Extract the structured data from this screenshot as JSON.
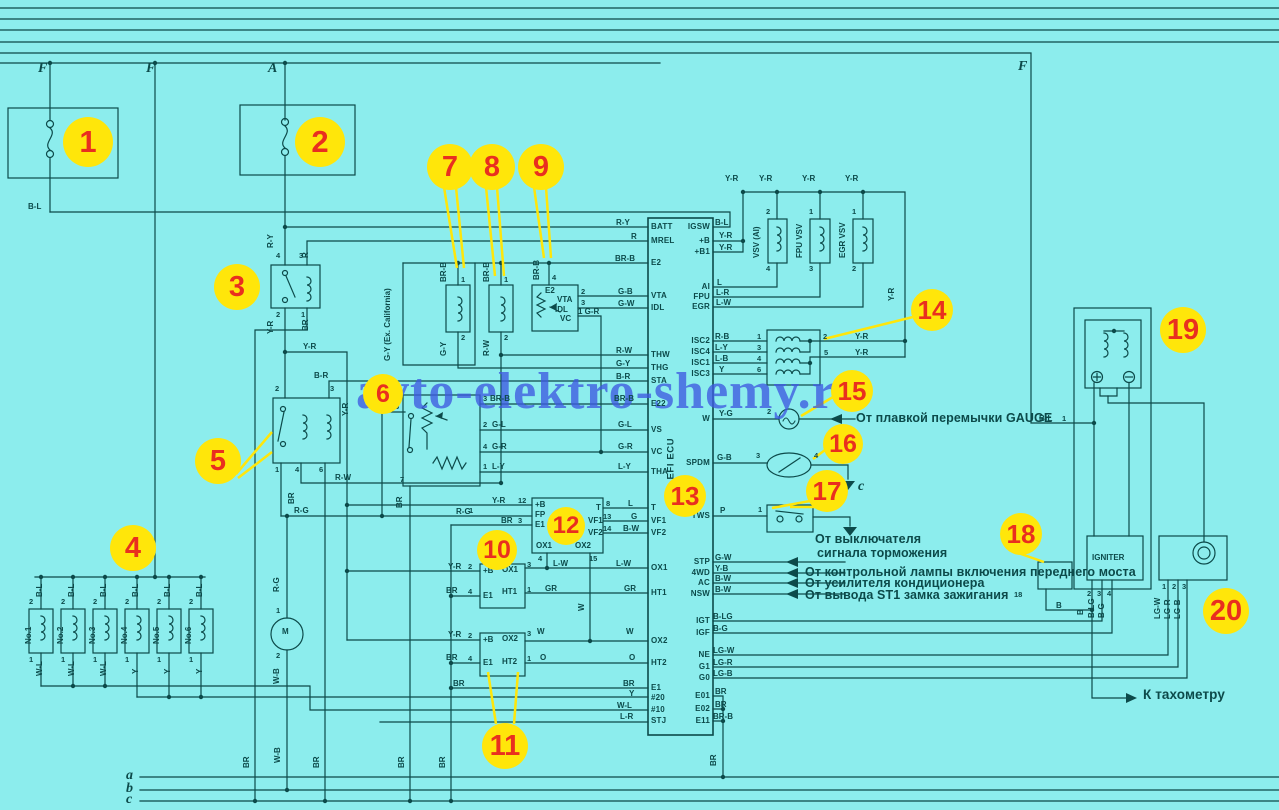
{
  "watermark": "avto-elektro-shemy.ru",
  "palette": {
    "background": "#8ceded",
    "ink": "#0c4a4a",
    "badge_fill": "#ffe60a",
    "badge_number": "#e92f1f",
    "watermark_color": "#3d5ae0"
  },
  "ecu": {
    "label": "EFI ECU",
    "left_pins": [
      [
        "BATT",
        227
      ],
      [
        "MREL",
        241
      ],
      [
        "E2",
        263
      ],
      [
        "VTA",
        296
      ],
      [
        "IDL",
        308
      ],
      [
        "THW",
        355
      ],
      [
        "THG",
        368
      ],
      [
        "STA",
        381
      ],
      [
        "E22",
        404
      ],
      [
        "VS",
        430
      ],
      [
        "VC",
        452
      ],
      [
        "THA",
        472
      ],
      [
        "T",
        508
      ],
      [
        "VF1",
        521
      ],
      [
        "VF2",
        533
      ],
      [
        "OX1",
        568
      ],
      [
        "HT1",
        593
      ],
      [
        "OX2",
        641
      ],
      [
        "HT2",
        663
      ],
      [
        "E1",
        688
      ],
      [
        "#20",
        698
      ],
      [
        "#10",
        710
      ],
      [
        "STJ",
        721
      ]
    ],
    "right_pins": [
      [
        "IGSW",
        227
      ],
      [
        "+B",
        241
      ],
      [
        "+B1",
        252
      ],
      [
        "AI",
        287
      ],
      [
        "FPU",
        297
      ],
      [
        "EGR",
        307
      ],
      [
        "ISC2",
        341
      ],
      [
        "ISC4",
        352
      ],
      [
        "ISC1",
        363
      ],
      [
        "ISC3",
        374
      ],
      [
        "W",
        419
      ],
      [
        "SPDM",
        463
      ],
      [
        "TWS",
        516
      ],
      [
        "STP",
        562
      ],
      [
        "4WD",
        573
      ],
      [
        "AC",
        583
      ],
      [
        "NSW",
        594
      ],
      [
        "IGT",
        621
      ],
      [
        "IGF",
        633
      ],
      [
        "NE",
        655
      ],
      [
        "G1",
        667
      ],
      [
        "G0",
        678
      ],
      [
        "E01",
        696
      ],
      [
        "E02",
        709
      ],
      [
        "E11",
        721
      ]
    ]
  },
  "serif_labels": [
    [
      "F",
      38,
      62
    ],
    [
      "F",
      146,
      62
    ],
    [
      "A",
      268,
      62
    ],
    [
      "F",
      1018,
      60
    ],
    [
      "a",
      126,
      769
    ],
    [
      "b",
      126,
      782
    ],
    [
      "c",
      126,
      793
    ],
    [
      "c",
      858,
      480
    ]
  ],
  "annotations": [
    [
      "От плавкой перемычки GAUGE",
      856,
      412,
      ""
    ],
    [
      "От выключателя",
      815,
      533,
      ""
    ],
    [
      "сигнала торможения",
      817,
      547,
      ""
    ],
    [
      "От контрольной лампы включения переднего моста",
      805,
      566,
      ""
    ],
    [
      "От усилителя кондиционера",
      805,
      577,
      ""
    ],
    [
      "От вывода ST1 замка зажигания",
      805,
      589,
      ""
    ],
    [
      "К тахометру",
      1143,
      688,
      "big"
    ]
  ],
  "component_labels": [
    [
      "VSV (AI)",
      761,
      259,
      1
    ],
    [
      "FPU VSV",
      804,
      259,
      1
    ],
    [
      "EGR VSV",
      847,
      259,
      1
    ],
    [
      "IGNITER",
      1092,
      554,
      0
    ],
    [
      "M",
      282,
      628,
      0
    ],
    [
      "No.1",
      33,
      645,
      1
    ],
    [
      "No.2",
      65,
      645,
      1
    ],
    [
      "No.3",
      97,
      645,
      1
    ],
    [
      "No.4",
      129,
      645,
      1
    ],
    [
      "No.5",
      161,
      645,
      1
    ],
    [
      "No.6",
      193,
      645,
      1
    ],
    [
      "G-Y (Ex. California)",
      392,
      362,
      1
    ],
    [
      "E2",
      545,
      287,
      0
    ],
    [
      "VTA",
      557,
      296,
      0
    ],
    [
      "IDL",
      555,
      306,
      0
    ],
    [
      "VC",
      560,
      315,
      0
    ],
    [
      "+B",
      535,
      501,
      0
    ],
    [
      "FP",
      535,
      511,
      0
    ],
    [
      "E1",
      535,
      521,
      0
    ],
    [
      "T",
      596,
      504,
      0
    ],
    [
      "VF1",
      588,
      517,
      0
    ],
    [
      "VF2",
      588,
      529,
      0
    ],
    [
      "OX1",
      536,
      542,
      0
    ],
    [
      "OX2",
      575,
      542,
      0
    ],
    [
      "+B",
      483,
      567,
      0
    ],
    [
      "OX1",
      502,
      566,
      0
    ],
    [
      "E1",
      483,
      592,
      0
    ],
    [
      "HT1",
      502,
      588,
      0
    ],
    [
      "+B",
      483,
      636,
      0
    ],
    [
      "OX2",
      502,
      635,
      0
    ],
    [
      "E1",
      483,
      659,
      0
    ],
    [
      "HT2",
      502,
      658,
      0
    ]
  ],
  "wire_labels": [
    [
      "B-L",
      28,
      203,
      0
    ],
    [
      "R-Y",
      616,
      219,
      0
    ],
    [
      "R",
      631,
      233,
      0
    ],
    [
      "BR-B",
      615,
      255,
      0
    ],
    [
      "G-B",
      618,
      288,
      0
    ],
    [
      "G-W",
      618,
      300,
      0
    ],
    [
      "1 G-R",
      578,
      308,
      0
    ],
    [
      "R-W",
      616,
      347,
      0
    ],
    [
      "G-Y",
      616,
      360,
      0
    ],
    [
      "B-R",
      616,
      373,
      0
    ],
    [
      "B-R",
      314,
      372,
      0
    ],
    [
      "Y-R",
      303,
      343,
      0
    ],
    [
      "BR-B",
      614,
      395,
      0
    ],
    [
      "G-L",
      618,
      421,
      0
    ],
    [
      "G-R",
      618,
      443,
      0
    ],
    [
      "L-Y",
      618,
      463,
      0
    ],
    [
      "BR-B",
      490,
      395,
      0
    ],
    [
      "G-L",
      492,
      421,
      0
    ],
    [
      "G-R",
      492,
      443,
      0
    ],
    [
      "L-Y",
      492,
      463,
      0
    ],
    [
      "L",
      628,
      500,
      0
    ],
    [
      "G",
      631,
      513,
      0
    ],
    [
      "B-W",
      623,
      525,
      0
    ],
    [
      "Y-R",
      492,
      497,
      0
    ],
    [
      "R-G",
      456,
      508,
      0
    ],
    [
      "BR",
      501,
      517,
      0
    ],
    [
      "L-W",
      553,
      560,
      0
    ],
    [
      "L-W",
      616,
      560,
      0
    ],
    [
      "GR",
      545,
      585,
      0
    ],
    [
      "GR",
      624,
      585,
      0
    ],
    [
      "W",
      537,
      628,
      0
    ],
    [
      "W",
      626,
      628,
      0
    ],
    [
      "O",
      540,
      654,
      0
    ],
    [
      "O",
      629,
      654,
      0
    ],
    [
      "BR",
      453,
      680,
      0
    ],
    [
      "BR",
      623,
      680,
      0
    ],
    [
      "Y",
      629,
      690,
      0
    ],
    [
      "W-L",
      617,
      702,
      0
    ],
    [
      "L-R",
      620,
      713,
      0
    ],
    [
      "Y-R",
      448,
      563,
      0
    ],
    [
      "BR",
      446,
      587,
      0
    ],
    [
      "Y-R",
      448,
      631,
      0
    ],
    [
      "BR",
      446,
      654,
      0
    ],
    [
      "R-W",
      335,
      474,
      0
    ],
    [
      "R-G",
      294,
      507,
      0
    ],
    [
      "B-L",
      715,
      219,
      0
    ],
    [
      "Y-R",
      719,
      232,
      0
    ],
    [
      "Y-R",
      719,
      244,
      0
    ],
    [
      "L",
      717,
      279,
      0
    ],
    [
      "L-R",
      716,
      289,
      0
    ],
    [
      "L-W",
      716,
      299,
      0
    ],
    [
      "R-B",
      715,
      333,
      0
    ],
    [
      "L-Y",
      715,
      344,
      0
    ],
    [
      "L-B",
      715,
      355,
      0
    ],
    [
      "Y",
      719,
      366,
      0
    ],
    [
      "Y-G",
      719,
      410,
      0
    ],
    [
      "G-B",
      717,
      454,
      0
    ],
    [
      "P",
      720,
      507,
      0
    ],
    [
      "G-W",
      715,
      554,
      0
    ],
    [
      "Y-B",
      715,
      565,
      0
    ],
    [
      "B-W",
      715,
      575,
      0
    ],
    [
      "B-W",
      715,
      586,
      0
    ],
    [
      "B-LG",
      713,
      613,
      0
    ],
    [
      "B-G",
      713,
      625,
      0
    ],
    [
      "LG-W",
      713,
      647,
      0
    ],
    [
      "LG-R",
      713,
      659,
      0
    ],
    [
      "LG-B",
      713,
      670,
      0
    ],
    [
      "BR",
      715,
      688,
      0
    ],
    [
      "BR",
      715,
      701,
      0
    ],
    [
      "BR-B",
      713,
      713,
      0
    ],
    [
      "Y-R",
      725,
      175,
      0
    ],
    [
      "Y-R",
      759,
      175,
      0
    ],
    [
      "Y-R",
      802,
      175,
      0
    ],
    [
      "Y-R",
      845,
      175,
      0
    ],
    [
      "Y-R",
      855,
      333,
      0
    ],
    [
      "Y-R",
      855,
      349,
      0
    ],
    [
      "B-L",
      1039,
      415,
      0
    ],
    [
      "B",
      1056,
      602,
      0
    ],
    [
      "R-Y",
      275,
      249,
      1
    ],
    [
      "R",
      310,
      259,
      1
    ],
    [
      "Y-R",
      275,
      335,
      1
    ],
    [
      "BR",
      310,
      332,
      1
    ],
    [
      "Y-R",
      350,
      417,
      1
    ],
    [
      "BR-B",
      448,
      283,
      1
    ],
    [
      "BR-B",
      491,
      283,
      1
    ],
    [
      "BR-B",
      541,
      281,
      1
    ],
    [
      "G-Y",
      448,
      357,
      1
    ],
    [
      "R-W",
      491,
      357,
      1
    ],
    [
      "R-G",
      281,
      593,
      1
    ],
    [
      "W-B",
      281,
      685,
      1
    ],
    [
      "BR",
      296,
      505,
      1
    ],
    [
      "BR",
      404,
      509,
      1
    ],
    [
      "BR",
      251,
      769,
      1
    ],
    [
      "W-B",
      282,
      764,
      1
    ],
    [
      "BR",
      321,
      769,
      1
    ],
    [
      "BR",
      406,
      769,
      1
    ],
    [
      "BR",
      447,
      769,
      1
    ],
    [
      "BR",
      718,
      767,
      1
    ],
    [
      "B-L",
      44,
      598,
      1
    ],
    [
      "B-L",
      76,
      598,
      1
    ],
    [
      "B-L",
      108,
      598,
      1
    ],
    [
      "B-L",
      140,
      598,
      1
    ],
    [
      "B-L",
      172,
      598,
      1
    ],
    [
      "B-L",
      204,
      598,
      1
    ],
    [
      "W-L",
      44,
      677,
      1
    ],
    [
      "W-L",
      76,
      677,
      1
    ],
    [
      "W-L",
      108,
      677,
      1
    ],
    [
      "Y",
      140,
      675,
      1
    ],
    [
      "Y",
      172,
      675,
      1
    ],
    [
      "Y",
      204,
      675,
      1
    ],
    [
      "W",
      586,
      612,
      1
    ],
    [
      "B",
      1085,
      616,
      1
    ],
    [
      "B-LG",
      1096,
      619,
      1
    ],
    [
      "B-G",
      1106,
      619,
      1
    ],
    [
      "LG-W",
      1162,
      620,
      1
    ],
    [
      "LG-R",
      1172,
      620,
      1
    ],
    [
      "LG-B",
      1182,
      620,
      1
    ],
    [
      "Y-R",
      896,
      302,
      1
    ]
  ],
  "pin_numbers": [
    [
      "4",
      276,
      252
    ],
    [
      "3",
      299,
      252
    ],
    [
      "2",
      276,
      311
    ],
    [
      "1",
      301,
      311
    ],
    [
      "2",
      275,
      385
    ],
    [
      "3",
      330,
      385
    ],
    [
      "1",
      275,
      466
    ],
    [
      "4",
      295,
      466
    ],
    [
      "6",
      319,
      466
    ],
    [
      "1",
      461,
      276
    ],
    [
      "2",
      461,
      334
    ],
    [
      "1",
      504,
      276
    ],
    [
      "2",
      504,
      334
    ],
    [
      "4",
      552,
      274
    ],
    [
      "2",
      581,
      288
    ],
    [
      "3",
      581,
      299
    ],
    [
      "6",
      395,
      403
    ],
    [
      "7",
      400,
      476
    ],
    [
      "3",
      483,
      395
    ],
    [
      "2",
      483,
      421
    ],
    [
      "4",
      483,
      443
    ],
    [
      "1",
      483,
      463
    ],
    [
      "2",
      29,
      598
    ],
    [
      "2",
      61,
      598
    ],
    [
      "2",
      93,
      598
    ],
    [
      "2",
      125,
      598
    ],
    [
      "2",
      157,
      598
    ],
    [
      "2",
      189,
      598
    ],
    [
      "1",
      29,
      656
    ],
    [
      "1",
      61,
      656
    ],
    [
      "1",
      93,
      656
    ],
    [
      "1",
      125,
      656
    ],
    [
      "1",
      157,
      656
    ],
    [
      "1",
      189,
      656
    ],
    [
      "1",
      276,
      607
    ],
    [
      "2",
      276,
      652
    ],
    [
      "12",
      518,
      497
    ],
    [
      "1",
      469,
      507
    ],
    [
      "3",
      518,
      517
    ],
    [
      "8",
      606,
      500
    ],
    [
      "13",
      603,
      513
    ],
    [
      "14",
      603,
      525
    ],
    [
      "4",
      538,
      555
    ],
    [
      "15",
      589,
      555
    ],
    [
      "2",
      468,
      563
    ],
    [
      "4",
      468,
      588
    ],
    [
      "3",
      527,
      561
    ],
    [
      "1",
      527,
      586
    ],
    [
      "2",
      468,
      632
    ],
    [
      "4",
      468,
      655
    ],
    [
      "3",
      527,
      630
    ],
    [
      "1",
      527,
      655
    ],
    [
      "1",
      757,
      333
    ],
    [
      "3",
      757,
      344
    ],
    [
      "4",
      757,
      355
    ],
    [
      "6",
      757,
      366
    ],
    [
      "2",
      823,
      333
    ],
    [
      "5",
      824,
      349
    ],
    [
      "2",
      766,
      208
    ],
    [
      "4",
      766,
      265
    ],
    [
      "1",
      809,
      208
    ],
    [
      "3",
      809,
      265
    ],
    [
      "1",
      852,
      208
    ],
    [
      "2",
      852,
      265
    ],
    [
      "2",
      767,
      408
    ],
    [
      "3",
      756,
      452
    ],
    [
      "4",
      814,
      452
    ],
    [
      "1",
      758,
      506
    ],
    [
      "1",
      1062,
      415
    ],
    [
      "2",
      1087,
      590
    ],
    [
      "3",
      1097,
      590
    ],
    [
      "4",
      1107,
      590
    ],
    [
      "18",
      1014,
      591
    ],
    [
      "1",
      1162,
      583
    ],
    [
      "2",
      1172,
      583
    ],
    [
      "3",
      1182,
      583
    ]
  ],
  "badges": [
    [
      1,
      88,
      142,
      50
    ],
    [
      2,
      320,
      142,
      50
    ],
    [
      3,
      237,
      287,
      46
    ],
    [
      4,
      133,
      548,
      46
    ],
    [
      5,
      218,
      461,
      46
    ],
    [
      6,
      383,
      394,
      40
    ],
    [
      7,
      450,
      167,
      46
    ],
    [
      8,
      492,
      167,
      46
    ],
    [
      9,
      541,
      167,
      46
    ],
    [
      10,
      497,
      550,
      40
    ],
    [
      11,
      505,
      746,
      46
    ],
    [
      12,
      566,
      526,
      38
    ],
    [
      13,
      685,
      496,
      42
    ],
    [
      14,
      932,
      310,
      42
    ],
    [
      15,
      852,
      391,
      42
    ],
    [
      16,
      843,
      444,
      40
    ],
    [
      17,
      827,
      491,
      42
    ],
    [
      18,
      1021,
      534,
      42
    ],
    [
      19,
      1183,
      330,
      46
    ],
    [
      20,
      1226,
      611,
      46
    ]
  ]
}
